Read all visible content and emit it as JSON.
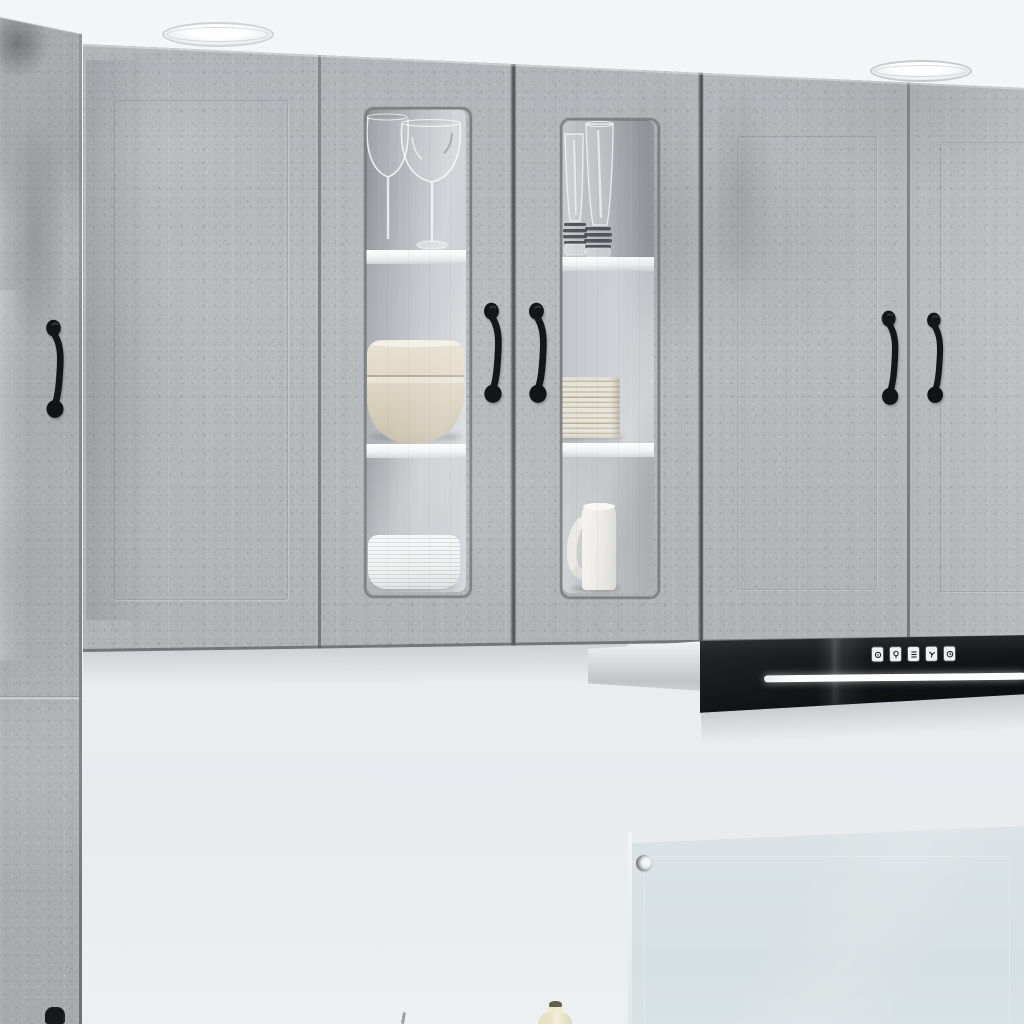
{
  "scene": {
    "subject": "concrete-gray kitchen wall cabinets with glass display doors, black range hood and glass backsplash",
    "ceiling_lights": {
      "count": 2,
      "style": "recessed-round"
    },
    "upper_cabinets": {
      "finish": "concrete gray",
      "solid_doors": 4,
      "glass_doors": 2,
      "handle_style": "black vintage spoon-foot pull",
      "handle_count": 5
    },
    "tall_left_unit": {
      "finish": "concrete gray",
      "handles": 2
    },
    "glass_door_1_contents": [
      "two wine glasses",
      "stacked beige bowls",
      "white ribbed bowl"
    ],
    "glass_door_2_contents": [
      "two tall pilsner glasses",
      "stack of cream plates",
      "white mug"
    ],
    "range_hood": {
      "color": "black",
      "button_count": 5,
      "light_strip": true,
      "side_panel": "light gray"
    },
    "backsplash": {
      "material": "glass panel",
      "fastener_count": 1
    },
    "countertop_items": [
      "oil bottle",
      "utensil tip"
    ]
  },
  "palette": {
    "ceiling": "#f3f5f7",
    "wall": "#eaeef1",
    "concrete_base": "#b2b5b8",
    "seam": "#7a7d80",
    "handle": "#16181a",
    "hood": "#1a1c1e",
    "led": "#fcfdfe",
    "shelf": "#f0f1f2",
    "backsplash": "#dbe3e6",
    "bowl_beige": "#d9d2bf",
    "plate_cream": "#e2ded1",
    "dish_white": "#f3f4f5",
    "oil": "#eae4c8",
    "oil_cap": "#62624a"
  }
}
